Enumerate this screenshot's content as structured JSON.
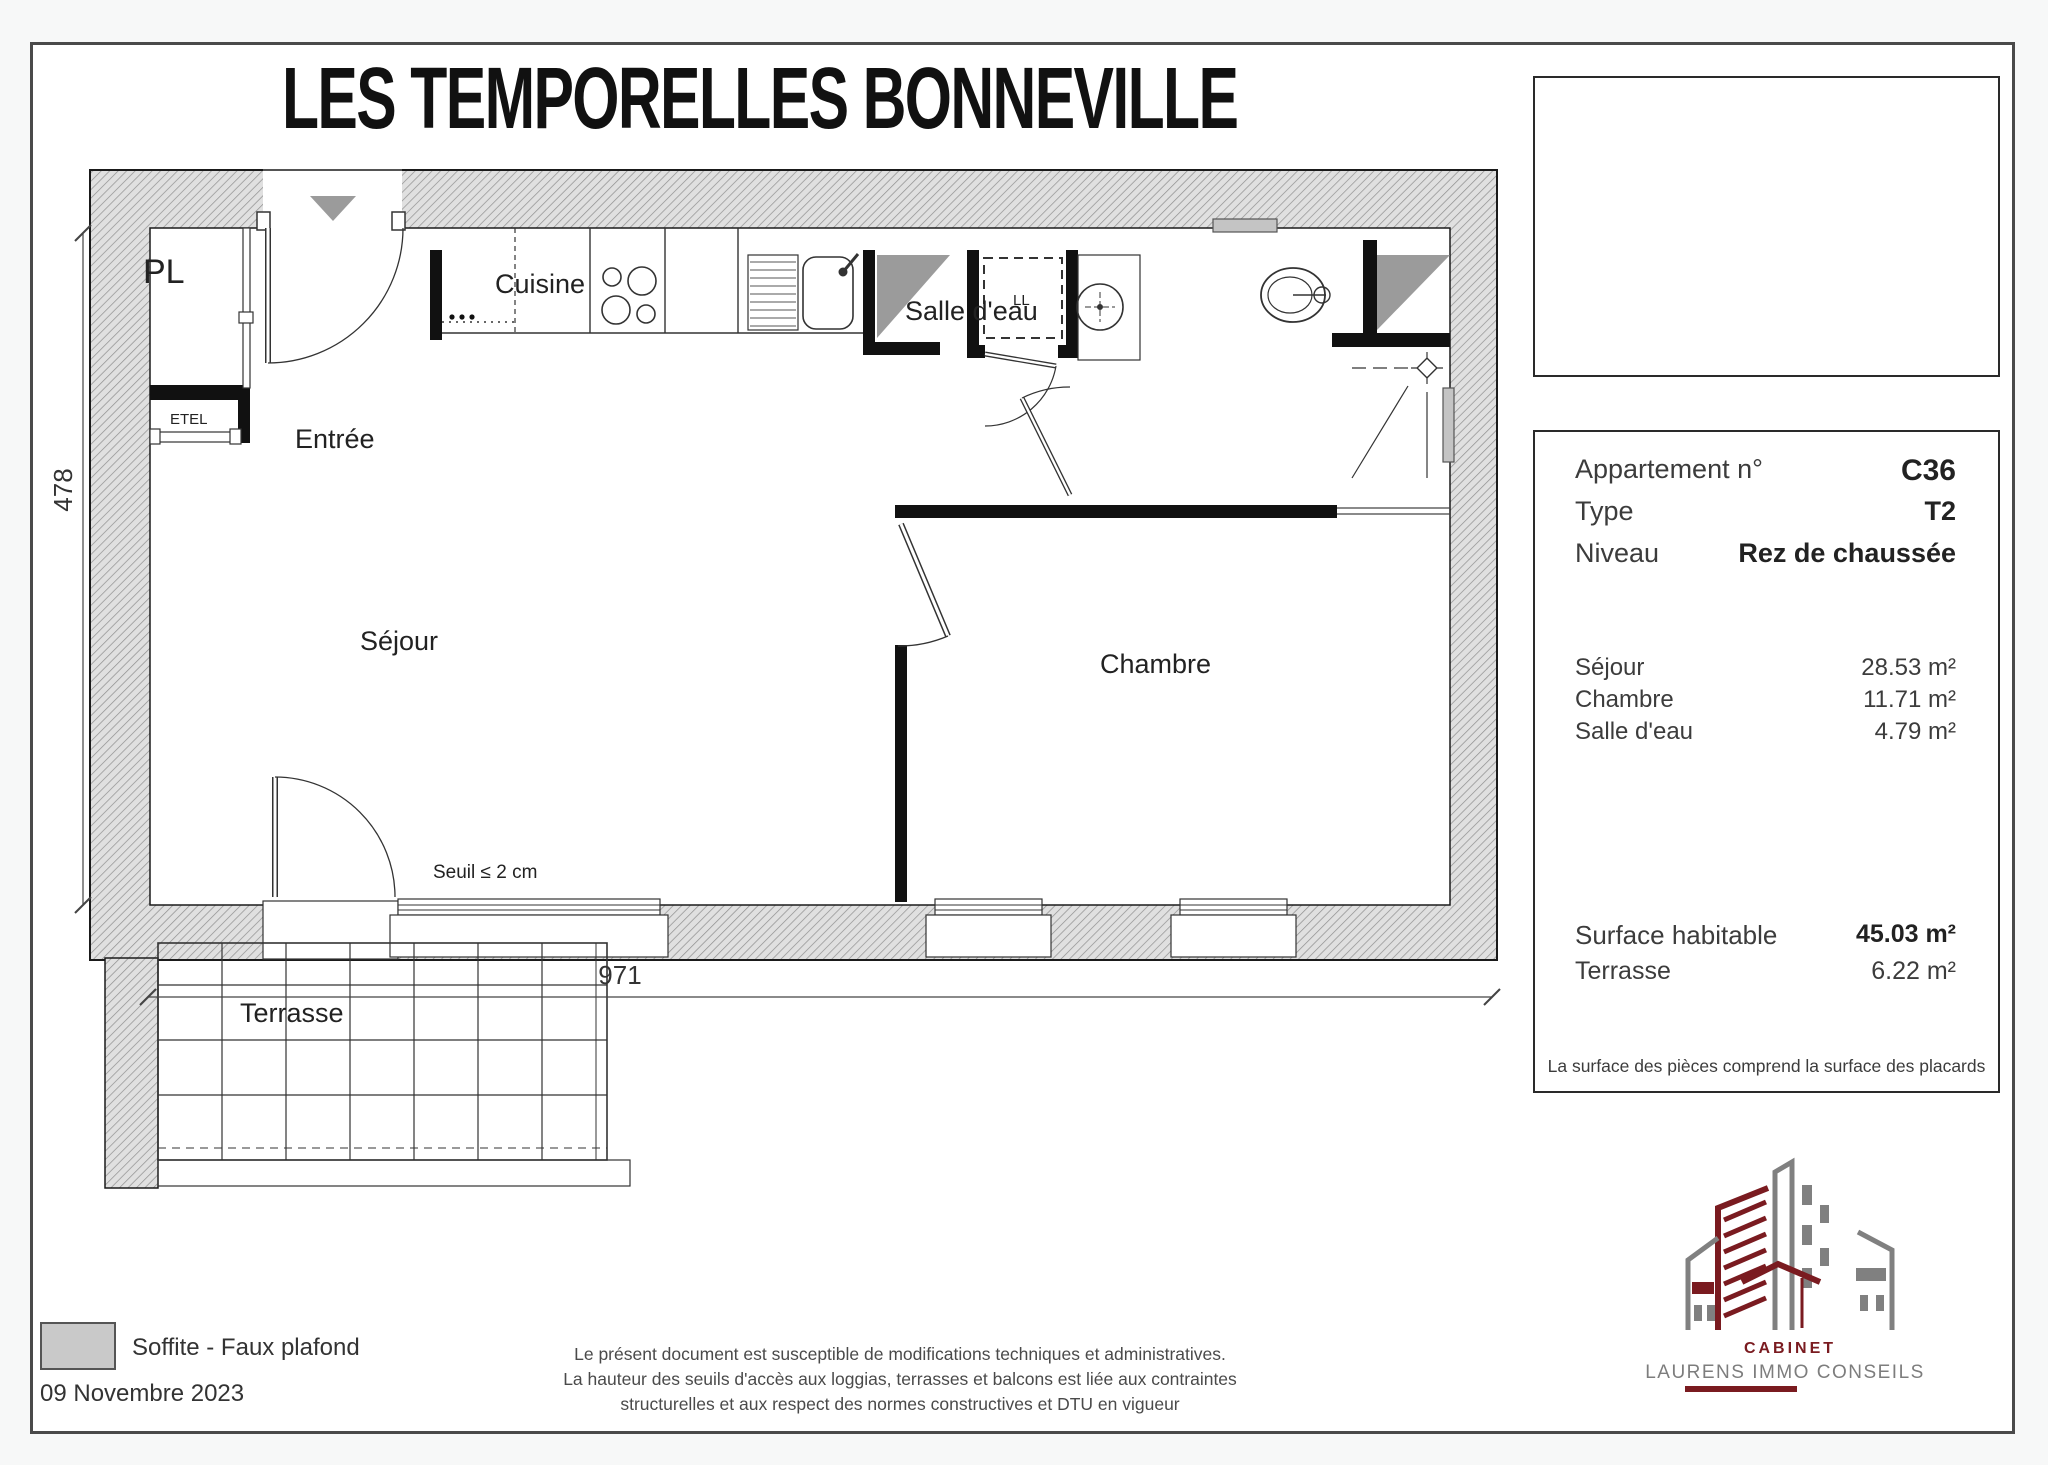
{
  "title": "LES TEMPORELLES BONNEVILLE",
  "info_panel": {
    "apartment_label": "Appartement n°",
    "apartment_value": "C36",
    "type_label": "Type",
    "type_value": "T2",
    "level_label": "Niveau",
    "level_value": "Rez de chaussée",
    "rooms": [
      {
        "label": "Séjour",
        "area": "28.53 m²"
      },
      {
        "label": "Chambre",
        "area": "11.71 m²"
      },
      {
        "label": "Salle d'eau",
        "area": "4.79 m²"
      }
    ],
    "surface_label": "Surface habitable",
    "surface_value": "45.03 m²",
    "terrace_label": "Terrasse",
    "terrace_value": "6.22 m²",
    "note": "La surface des pièces comprend la surface des placards"
  },
  "floor_plan": {
    "labels": {
      "pl": "PL",
      "etel": "ETEL",
      "entree": "Entrée",
      "cuisine": "Cuisine",
      "ll": "LL",
      "salle_deau": "Salle d'eau",
      "sejour": "Séjour",
      "chambre": "Chambre",
      "terrasse": "Terrasse"
    },
    "threshold_note": "Seuil ≤ 2 cm",
    "dim_width": "971",
    "dim_height": "478"
  },
  "site_plan": {
    "street_top": "AVENUE DE LA GARE",
    "street_bottom": "RUE DU CANAL",
    "building_label": "C"
  },
  "legend": {
    "soffit_label": "Soffite - Faux plafond",
    "date": "09 Novembre 2023"
  },
  "disclaimer": {
    "line1": "Le présent document est susceptible de modifications techniques et administratives.",
    "line2": "La hauteur des seuils d'accès aux loggias, terrasses et balcons est liée aux contraintes",
    "line3": "structurelles et aux respect des normes constructives et DTU en vigueur"
  },
  "logo": {
    "line1": "Cabinet",
    "line2": "LAURENS IMMO CONSEILS"
  },
  "colors": {
    "accent_maroon": "#7a1b20",
    "soffit_grey": "#9b9b9b",
    "legend_grey": "#c9c9c9",
    "site_marker_grey": "#787878"
  }
}
